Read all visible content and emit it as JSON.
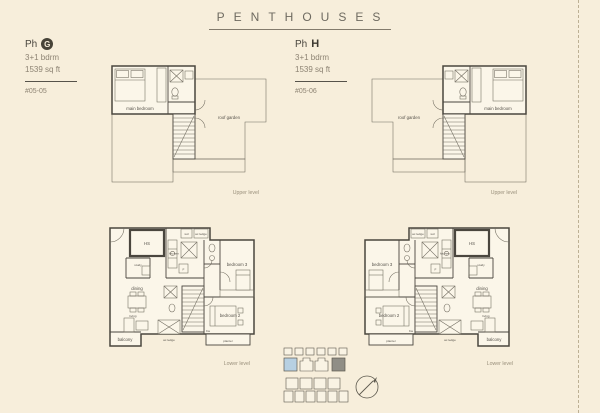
{
  "title": "PENTHOUSES",
  "units": {
    "g": {
      "ph": "Ph",
      "letter": "G",
      "bdrm": "3+1 bdrm",
      "area": "1539 sq ft",
      "unit_no": "#05-05"
    },
    "h": {
      "ph": "Ph",
      "letter": "H",
      "bdrm": "3+1 bdrm",
      "area": "1539 sq ft",
      "unit_no": "#05-06"
    }
  },
  "levels": {
    "upper": "Upper level",
    "lower": "Lower level"
  },
  "rooms": {
    "main_bedroom": "main bedroom",
    "roof_garden": "roof garden",
    "hs": "HS",
    "study": "study",
    "dining": "dining",
    "living": "living",
    "balcony": "balcony",
    "kitchen": "kitchen",
    "bedroom_2": "bedroom 2",
    "bedroom_3": "bedroom 3",
    "ac_ledge": "ac ledge",
    "planter": "planter",
    "wd": "wd",
    "fridge": "F",
    "bw": "bw"
  },
  "colors": {
    "background": "#f7eedb",
    "wall": "#4a463e",
    "highlight_blue": "#b7d0e2",
    "highlight_gray": "#908e86",
    "muted_text": "#9a907c"
  }
}
